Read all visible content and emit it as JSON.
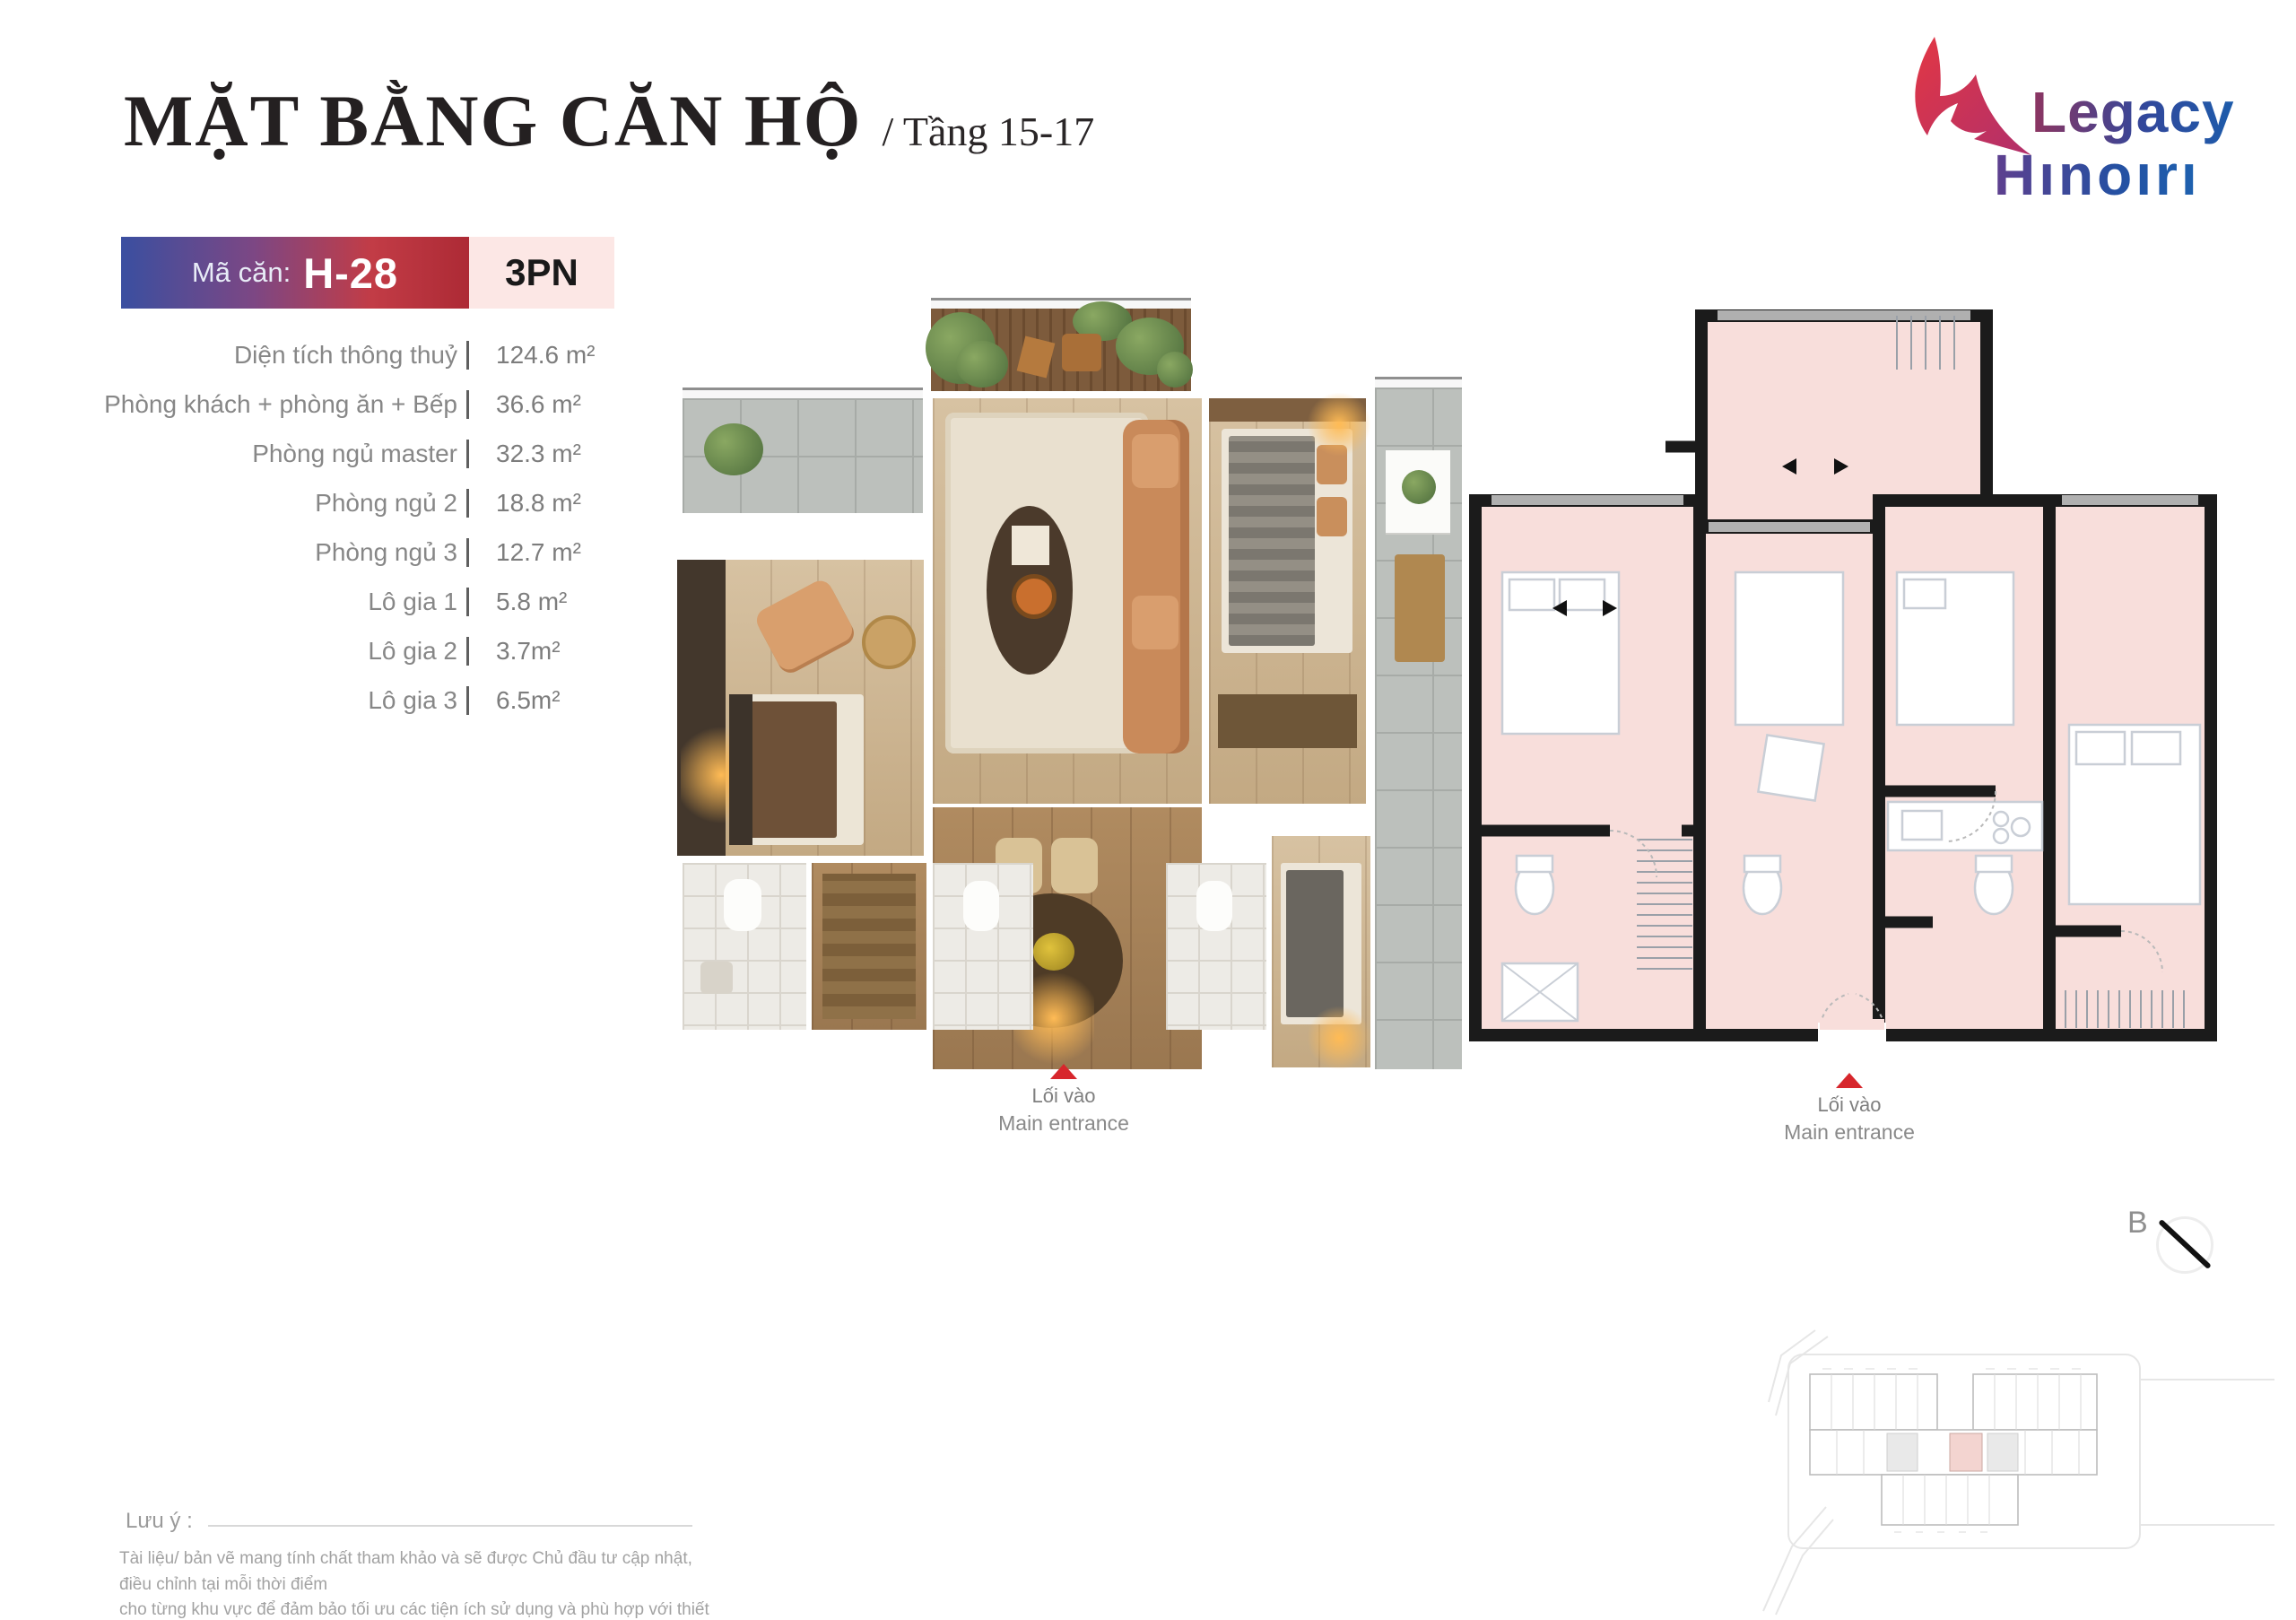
{
  "header": {
    "title": "MẶT BẰNG CĂN HỘ",
    "subtitle": "/ Tầng 15-17"
  },
  "logo": {
    "brand_line1": "Legacy",
    "brand_line2": "Hınoırı"
  },
  "unit": {
    "label": "Mã căn:",
    "code": "H-28",
    "bedrooms": "3PN"
  },
  "specs": [
    {
      "label": "Diện tích thông thuỷ",
      "value": "124.6 m²"
    },
    {
      "label": "Phòng khách + phòng ăn + Bếp",
      "value": "36.6 m²"
    },
    {
      "label": "Phòng ngủ master",
      "value": "32.3 m²"
    },
    {
      "label": "Phòng ngủ 2",
      "value": "18.8 m²"
    },
    {
      "label": "Phòng ngủ 3",
      "value": "12.7 m²"
    },
    {
      "label": "Lô gia 1",
      "value": "5.8 m²"
    },
    {
      "label": "Lô gia 2",
      "value": "3.7m²"
    },
    {
      "label": "Lô gia 3",
      "value": "6.5m²"
    }
  ],
  "entrance": {
    "vi": "Lối vào",
    "en": "Main entrance"
  },
  "compass": {
    "label": "B"
  },
  "note": {
    "label": "Lưu ý :",
    "line1": "Tài liệu/ bản vẽ mang tính chất tham khảo và sẽ được Chủ đầu tư cập nhật, điều chỉnh tại mỗi thời điểm",
    "line2": "cho từng khu vực để đảm bảo tối ưu các tiện ích sử dụng và phù hợp với thiết kế tổng thể của Dự án"
  },
  "colors": {
    "badge_gradient_start": "#3a4fa0",
    "badge_gradient_end": "#ad2a35",
    "bedroom_chip_bg": "#fce7e5",
    "plan_room_pink": "#f8dedb",
    "plan_wall_black": "#1b1b1b",
    "accent_red": "#d7262c",
    "logo_red": "#d93845",
    "logo_blue": "#1f4fa0",
    "site_unit_highlight": "#f3d4d0"
  }
}
